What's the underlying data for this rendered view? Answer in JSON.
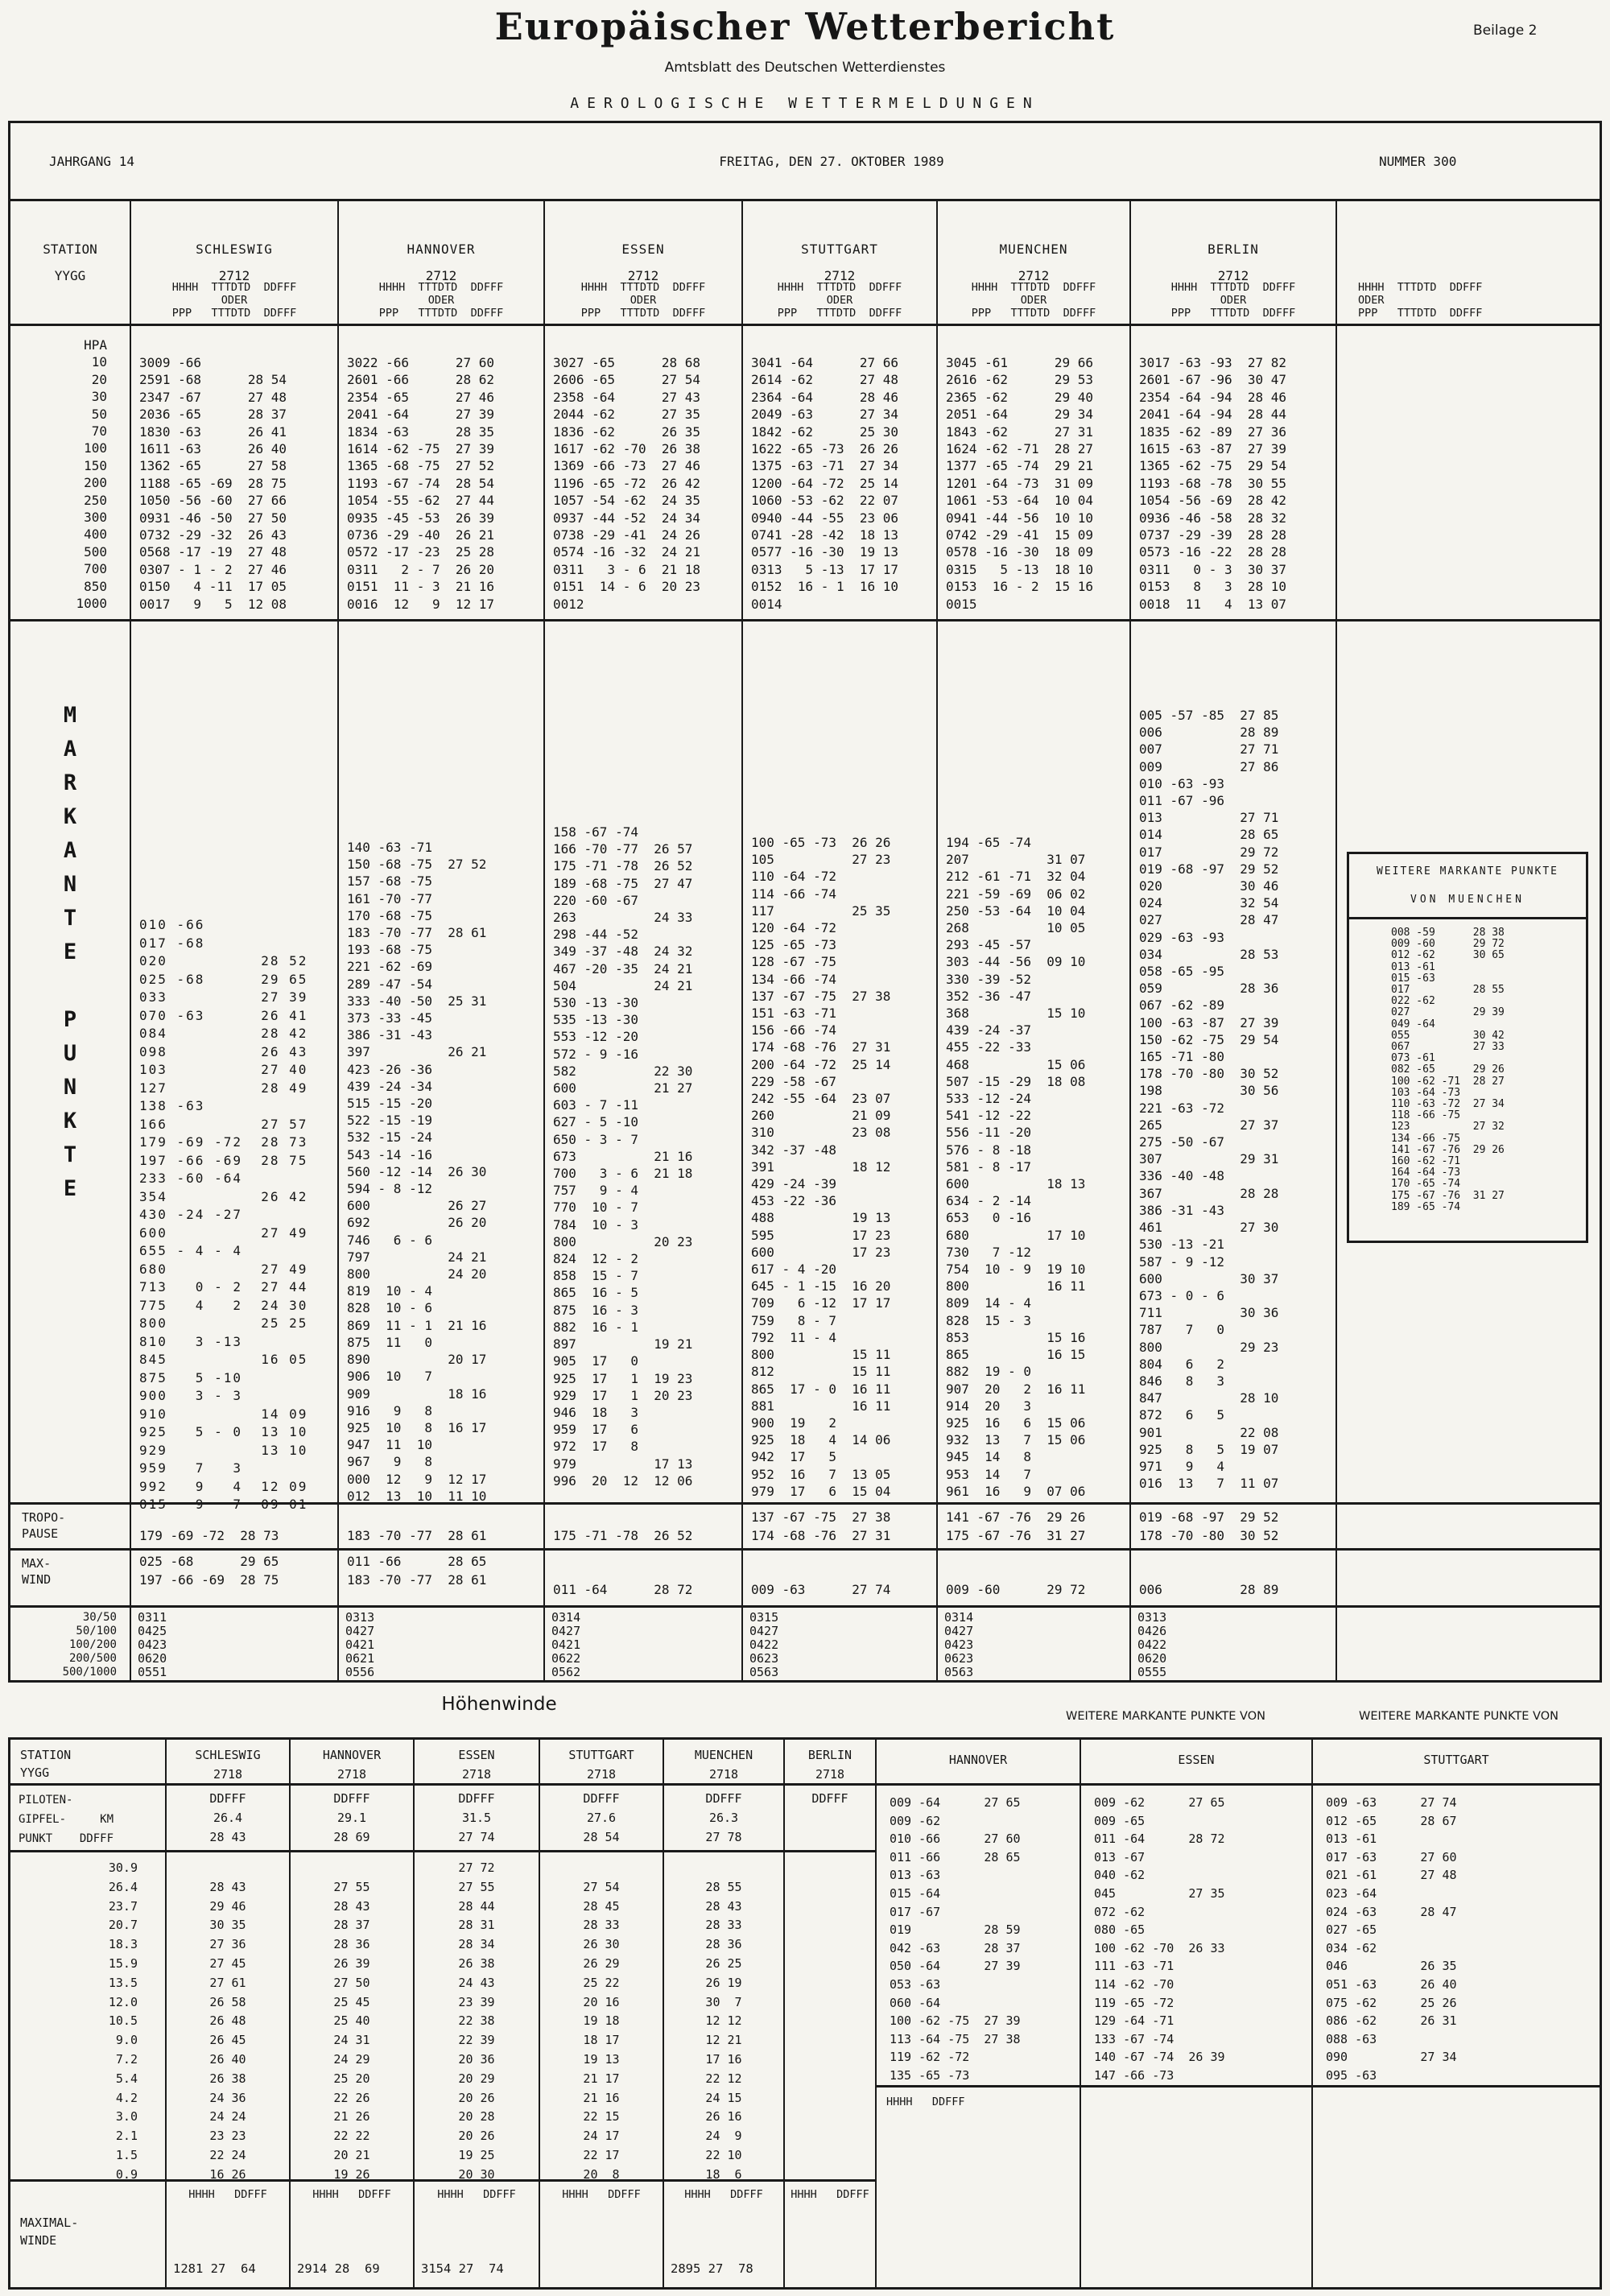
{
  "doc": {
    "title": "Europäischer Wetterbericht",
    "subtitle": "Amtsblatt des Deutschen Wetterdienstes",
    "section": "AEROLOGISCHE WETTERMELDUNGEN",
    "badge": "Beilage 2"
  },
  "infobar": {
    "left": "JAHRGANG 14",
    "center": "FREITAG, DEN 27. OKTOBER 1989",
    "right": "NUMMER 300"
  },
  "labels": {
    "station": "STATION",
    "yygg": "YYGG",
    "sub1": "HHHH  TTTDTD  DDFFF",
    "oder": "ODER",
    "sub2": "PPP   TTTDTD  DDFFF",
    "tropo": [
      "TROPO-",
      "PAUSE"
    ],
    "max": [
      "MAX-",
      "WIND"
    ],
    "ratios": [
      "30/50",
      "50/100",
      "100/200",
      "200/500",
      "500/1000"
    ],
    "markante_vertical": [
      "M",
      "A",
      "R",
      "K",
      "A",
      "N",
      "T",
      "E",
      " ",
      "P",
      "U",
      "N",
      "K",
      "T",
      "E"
    ],
    "hpa_levels": [
      "HPA",
      "10",
      "20",
      "30",
      "50",
      "70",
      "100",
      "150",
      "200",
      "250",
      "300",
      "400",
      "500",
      "700",
      "850",
      "1000"
    ]
  },
  "top_table": {
    "stations": [
      {
        "name": "SCHLESWIG",
        "yygg": "2712",
        "hpa": [
          "3009 -66",
          "2591 -68      28 54",
          "2347 -67      27 48",
          "2036 -65      28 37",
          "1830 -63      26 41",
          "1611 -63      26 40",
          "1362 -65      27 58",
          "1188 -65 -69  28 75",
          "1050 -56 -60  27 66",
          "0931 -46 -50  27 50",
          "0732 -29 -32  26 43",
          "0568 -17 -19  27 48",
          "0307 - 1 - 2  27 46",
          "0150   4 -11  17 05",
          "0017   9   5  12 08"
        ],
        "mark": [
          "010 -66",
          "017 -68",
          "020          28 52",
          "025 -68      29 65",
          "033          27 39",
          "070 -63      26 41",
          "084          28 42",
          "098          26 43",
          "103          27 40",
          "127          28 49",
          "138 -63",
          "166          27 57",
          "179 -69 -72  28 73",
          "197 -66 -69  28 75",
          "233 -60 -64",
          "354          26 42",
          "430 -24 -27",
          "600          27 49",
          "655 - 4 - 4",
          "680          27 49",
          "713   0 - 2  27 44",
          "775   4   2  24 30",
          "800          25 25",
          "810   3 -13",
          "845          16 05",
          "875   5 -10",
          "900   3 - 3",
          "910          14 09",
          "925   5 - 0  13 10",
          "929          13 10",
          "959   7   3",
          "992   9   4  12 09",
          "015   9   7  09 01"
        ],
        "tropo": [
          "179 -69 -72  28 73"
        ],
        "max": [
          "025 -68      29 65",
          "197 -66 -69  28 75"
        ],
        "ratios": [
          "0311",
          "0425",
          "0423",
          "0620",
          "0551"
        ]
      },
      {
        "name": "HANNOVER",
        "yygg": "2712",
        "hpa": [
          "3022 -66      27 60",
          "2601 -66      28 62",
          "2354 -65      27 46",
          "2041 -64      27 39",
          "1834 -63      28 35",
          "1614 -62 -75  27 39",
          "1365 -68 -75  27 52",
          "1193 -67 -74  28 54",
          "1054 -55 -62  27 44",
          "0935 -45 -53  26 39",
          "0736 -29 -40  26 21",
          "0572 -17 -23  25 28",
          "0311   2 - 7  26 20",
          "0151  11 - 3  21 16",
          "0016  12   9  12 17"
        ],
        "mark": [
          "140 -63 -71",
          "150 -68 -75  27 52",
          "157 -68 -75",
          "161 -70 -77",
          "170 -68 -75",
          "183 -70 -77  28 61",
          "193 -68 -75",
          "221 -62 -69",
          "289 -47 -54",
          "333 -40 -50  25 31",
          "373 -33 -45",
          "386 -31 -43",
          "397          26 21",
          "423 -26 -36",
          "439 -24 -34",
          "515 -15 -20",
          "522 -15 -19",
          "532 -15 -24",
          "543 -14 -16",
          "560 -12 -14  26 30",
          "594 - 8 -12",
          "600          26 27",
          "692          26 20",
          "746   6 - 6",
          "797          24 21",
          "800          24 20",
          "819  10 - 4",
          "828  10 - 6",
          "869  11 - 1  21 16",
          "875  11   0",
          "890          20 17",
          "906  10   7",
          "909          18 16",
          "916   9   8",
          "925  10   8  16 17",
          "947  11  10",
          "967   9   8",
          "000  12   9  12 17",
          "012  13  10  11 10"
        ],
        "tropo": [
          "183 -70 -77  28 61"
        ],
        "max": [
          "011 -66      28 65",
          "183 -70 -77  28 61"
        ],
        "ratios": [
          "0313",
          "0427",
          "0421",
          "0621",
          "0556"
        ]
      },
      {
        "name": "ESSEN",
        "yygg": "2712",
        "hpa": [
          "3027 -65      28 68",
          "2606 -65      27 54",
          "2358 -64      27 43",
          "2044 -62      27 35",
          "1836 -62      26 35",
          "1617 -62 -70  26 38",
          "1369 -66 -73  27 46",
          "1196 -65 -72  26 42",
          "1057 -54 -62  24 35",
          "0937 -44 -52  24 34",
          "0738 -29 -41  24 26",
          "0574 -16 -32  24 21",
          "0311   3 - 6  21 18",
          "0151  14 - 6  20 23",
          "0012"
        ],
        "mark": [
          "158 -67 -74",
          "166 -70 -77  26 57",
          "175 -71 -78  26 52",
          "189 -68 -75  27 47",
          "220 -60 -67",
          "263          24 33",
          "298 -44 -52",
          "349 -37 -48  24 32",
          "467 -20 -35  24 21",
          "504          24 21",
          "530 -13 -30",
          "535 -13 -30",
          "553 -12 -20",
          "572 - 9 -16",
          "582          22 30",
          "600          21 27",
          "603 - 7 -11",
          "627 - 5 -10",
          "650 - 3 - 7",
          "673          21 16",
          "700   3 - 6  21 18",
          "757   9 - 4",
          "770  10 - 7",
          "784  10 - 3",
          "800          20 23",
          "824  12 - 2",
          "858  15 - 7",
          "865  16 - 5",
          "875  16 - 3",
          "882  16 - 1",
          "897          19 21",
          "905  17   0",
          "925  17   1  19 23",
          "929  17   1  20 23",
          "946  18   3",
          "959  17   6",
          "972  17   8",
          "979          17 13",
          "996  20  12  12 06"
        ],
        "tropo": [
          "175 -71 -78  26 52"
        ],
        "max": [
          "011 -64      28 72"
        ],
        "ratios": [
          "0314",
          "0427",
          "0421",
          "0622",
          "0562"
        ]
      },
      {
        "name": "STUTTGART",
        "yygg": "2712",
        "hpa": [
          "3041 -64      27 66",
          "2614 -62      27 48",
          "2364 -64      28 46",
          "2049 -63      27 34",
          "1842 -62      25 30",
          "1622 -65 -73  26 26",
          "1375 -63 -71  27 34",
          "1200 -64 -72  25 14",
          "1060 -53 -62  22 07",
          "0940 -44 -55  23 06",
          "0741 -28 -42  18 13",
          "0577 -16 -30  19 13",
          "0313   5 -13  17 17",
          "0152  16 - 1  16 10",
          "0014"
        ],
        "mark": [
          "100 -65 -73  26 26",
          "105          27 23",
          "110 -64 -72",
          "114 -66 -74",
          "117          25 35",
          "120 -64 -72",
          "125 -65 -73",
          "128 -67 -75",
          "134 -66 -74",
          "137 -67 -75  27 38",
          "151 -63 -71",
          "156 -66 -74",
          "174 -68 -76  27 31",
          "200 -64 -72  25 14",
          "229 -58 -67",
          "242 -55 -64  23 07",
          "260          21 09",
          "310          23 08",
          "342 -37 -48",
          "391          18 12",
          "429 -24 -39",
          "453 -22 -36",
          "488          19 13",
          "595          17 23",
          "600          17 23",
          "617 - 4 -20",
          "645 - 1 -15  16 20",
          "709   6 -12  17 17",
          "759   8 - 7",
          "792  11 - 4",
          "800          15 11",
          "812          15 11",
          "865  17 - 0  16 11",
          "881          16 11",
          "900  19   2",
          "925  18   4  14 06",
          "942  17   5",
          "952  16   7  13 05",
          "979  17   6  15 04"
        ],
        "tropo": [
          "137 -67 -75  27 38",
          "174 -68 -76  27 31"
        ],
        "max": [
          "009 -63      27 74"
        ],
        "ratios": [
          "0315",
          "0427",
          "0422",
          "0623",
          "0563"
        ]
      },
      {
        "name": "MUENCHEN",
        "yygg": "2712",
        "hpa": [
          "3045 -61      29 66",
          "2616 -62      29 53",
          "2365 -62      29 40",
          "2051 -64      29 34",
          "1843 -62      27 31",
          "1624 -62 -71  28 27",
          "1377 -65 -74  29 21",
          "1201 -64 -73  31 09",
          "1061 -53 -64  10 04",
          "0941 -44 -56  10 10",
          "0742 -29 -41  15 09",
          "0578 -16 -30  18 09",
          "0315   5 -13  18 10",
          "0153  16 - 2  15 16",
          "0015"
        ],
        "mark": [
          "194 -65 -74",
          "207          31 07",
          "212 -61 -71  32 04",
          "221 -59 -69  06 02",
          "250 -53 -64  10 04",
          "268          10 05",
          "293 -45 -57",
          "303 -44 -56  09 10",
          "330 -39 -52",
          "352 -36 -47",
          "368          15 10",
          "439 -24 -37",
          "455 -22 -33",
          "468          15 06",
          "507 -15 -29  18 08",
          "533 -12 -24",
          "541 -12 -22",
          "556 -11 -20",
          "576 - 8 -18",
          "581 - 8 -17",
          "600          18 13",
          "634 - 2 -14",
          "653   0 -16",
          "680          17 10",
          "730   7 -12",
          "754  10 - 9  19 10",
          "800          16 11",
          "809  14 - 4",
          "828  15 - 3",
          "853          15 16",
          "865          16 15",
          "882  19 - 0",
          "907  20   2  16 11",
          "914  20   3",
          "925  16   6  15 06",
          "932  13   7  15 06",
          "945  14   8",
          "953  14   7",
          "961  16   9  07 06"
        ],
        "tropo": [
          "141 -67 -76  29 26",
          "175 -67 -76  31 27"
        ],
        "max": [
          "009 -60      29 72"
        ],
        "ratios": [
          "0314",
          "0427",
          "0423",
          "0623",
          "0563"
        ]
      },
      {
        "name": "BERLIN",
        "yygg": "2712",
        "hpa": [
          "3017 -63 -93  27 82",
          "2601 -67 -96  30 47",
          "2354 -64 -94  28 46",
          "2041 -64 -94  28 44",
          "1835 -62 -89  27 36",
          "1615 -63 -87  27 39",
          "1365 -62 -75  29 54",
          "1193 -68 -78  30 55",
          "1054 -56 -69  28 42",
          "0936 -46 -58  28 32",
          "0737 -29 -39  28 28",
          "0573 -16 -22  28 28",
          "0311   0 - 3  30 37",
          "0153   8   3  28 10",
          "0018  11   4  13 07"
        ],
        "mark": [
          "005 -57 -85  27 85",
          "006          28 89",
          "007          27 71",
          "009          27 86",
          "010 -63 -93",
          "011 -67 -96",
          "013          27 71",
          "014          28 65",
          "017          29 72",
          "019 -68 -97  29 52",
          "020          30 46",
          "024          32 54",
          "027          28 47",
          "029 -63 -93",
          "034          28 53",
          "058 -65 -95",
          "059          28 36",
          "067 -62 -89",
          "100 -63 -87  27 39",
          "150 -62 -75  29 54",
          "165 -71 -80",
          "178 -70 -80  30 52",
          "198          30 56",
          "221 -63 -72",
          "265          27 37",
          "275 -50 -67",
          "307          29 31",
          "336 -40 -48",
          "367          28 28",
          "386 -31 -43",
          "461          27 30",
          "530 -13 -21",
          "587 - 9 -12",
          "600          30 37",
          "673 - 0 - 6",
          "711          30 36",
          "787   7   0",
          "800          29 23",
          "804   6   2",
          "846   8   3",
          "847          28 10",
          "872   6   5",
          "901          22 08",
          "925   8   5  19 07",
          "971   9   4",
          "016  13   7  11 07"
        ],
        "tropo": [
          "019 -68 -97  29 52",
          "178 -70 -80  30 52"
        ],
        "max": [
          "006          28 89"
        ],
        "ratios": [
          "0313",
          "0426",
          "0422",
          "0620",
          "0555"
        ]
      }
    ]
  },
  "wmp_box": {
    "line1": "WEITERE MARKANTE PUNKTE",
    "line2": "VON  MUENCHEN",
    "lines": [
      "008 -59      28 38",
      "009 -60      29 72",
      "012 -62      30 65",
      "013 -61",
      "015 -63",
      "017          28 55",
      "022 -62",
      "027          29 39",
      "049 -64",
      "055          30 42",
      "067          27 33",
      "073 -61",
      "082 -65      29 26",
      "100 -62 -71  28 27",
      "103 -64 -73",
      "110 -63 -72  27 34",
      "118 -66 -75",
      "123          27 32",
      "134 -66 -75",
      "141 -67 -76  29 26",
      "160 -62 -71",
      "164 -64 -73",
      "170 -65 -74",
      "175 -67 -76  31 27",
      "189 -65 -74"
    ]
  },
  "hoehen": {
    "title": "Höhenwinde",
    "wmp_label_1": "WEITERE MARKANTE PUNKTE VON",
    "wmp_label_2": "WEITERE MARKANTE PUNKTE VON",
    "station": "STATION",
    "yygg": "YYGG",
    "piloten": [
      "PILOTEN-",
      "GIPFEL-     KM",
      "PUNKT    DDFFF"
    ],
    "maximal": [
      "MAXIMAL-",
      "WINDE"
    ],
    "hhhh_ddfff": "HHHH   DDFFF",
    "km": [
      " 30.9",
      " 26.4",
      " 23.7",
      " 20.7",
      " 18.3",
      " 15.9",
      " 13.5",
      " 12.0",
      " 10.5",
      "  9.0",
      "  7.2",
      "  5.4",
      "  4.2",
      "  3.0",
      "  2.1",
      "  1.5",
      "  0.9"
    ],
    "stations": [
      {
        "name": "SCHLESWIG",
        "yygg": "2718",
        "head": [
          "DDFFF",
          "26.4",
          "28 43"
        ],
        "winds": [
          "",
          "28 43",
          "29 46",
          "30 35",
          "27 36",
          "27 45",
          "27 61",
          "26 58",
          "26 48",
          "26 45",
          "26 40",
          "26 38",
          "24 36",
          "24 24",
          "23 23",
          "22 24",
          "16 26"
        ],
        "maxv": "1281 27  64"
      },
      {
        "name": "HANNOVER",
        "yygg": "2718",
        "head": [
          "DDFFF",
          "29.1",
          "28 69"
        ],
        "winds": [
          "",
          "27 55",
          "28 43",
          "28 37",
          "28 36",
          "26 39",
          "27 50",
          "25 45",
          "25 40",
          "24 31",
          "24 29",
          "25 20",
          "22 26",
          "21 26",
          "22 22",
          "20 21",
          "19 26"
        ],
        "maxv": "2914 28  69"
      },
      {
        "name": "ESSEN",
        "yygg": "2718",
        "head": [
          "DDFFF",
          "31.5",
          "27 74"
        ],
        "winds": [
          "27 72",
          "27 55",
          "28 44",
          "28 31",
          "28 34",
          "26 38",
          "24 43",
          "23 39",
          "22 38",
          "22 39",
          "20 36",
          "20 29",
          "20 26",
          "20 28",
          "20 26",
          "19 25",
          "20 30"
        ],
        "maxv": "3154 27  74"
      },
      {
        "name": "STUTTGART",
        "yygg": "2718",
        "head": [
          "DDFFF",
          "27.6",
          "28 54"
        ],
        "winds": [
          "",
          "27 54",
          "28 45",
          "28 33",
          "26 30",
          "26 29",
          "25 22",
          "20 16",
          "19 18",
          "18 17",
          "19 13",
          "21 17",
          "21 16",
          "22 15",
          "24 17",
          "22 17",
          "20  8"
        ],
        "maxv": ""
      },
      {
        "name": "MUENCHEN",
        "yygg": "2718",
        "head": [
          "DDFFF",
          "26.3",
          "27 78"
        ],
        "winds": [
          "",
          "28 55",
          "28 43",
          "28 33",
          "28 36",
          "26 25",
          "26 19",
          "30  7",
          "12 12",
          "12 21",
          "17 16",
          "22 12",
          "24 15",
          "26 16",
          "24  9",
          "22 10",
          "18  6"
        ],
        "maxv": "2895 27  78"
      },
      {
        "name": "BERLIN",
        "yygg": "2718",
        "head": [
          "DDFFF"
        ],
        "winds": [
          "",
          "",
          "",
          "",
          "",
          "",
          "",
          "",
          "",
          "",
          "",
          "",
          "",
          "",
          "",
          "",
          ""
        ],
        "maxv": ""
      }
    ],
    "wmp_cols": [
      {
        "name": "HANNOVER",
        "lines": [
          "009 -64      27 65",
          "009 -62",
          "010 -66      27 60",
          "011 -66      28 65",
          "013 -63",
          "015 -64",
          "017 -67",
          "019          28 59",
          "042 -63      28 37",
          "050 -64      27 39",
          "053 -63",
          "060 -64",
          "100 -62 -75  27 39",
          "113 -64 -75  27 38",
          "119 -62 -72",
          "135 -65 -73"
        ]
      },
      {
        "name": "ESSEN",
        "lines": [
          "009 -62      27 65",
          "009 -65",
          "011 -64      28 72",
          "013 -67",
          "040 -62",
          "045          27 35",
          "072 -62",
          "080 -65",
          "100 -62 -70  26 33",
          "111 -63 -71",
          "114 -62 -70",
          "119 -65 -72",
          "129 -64 -71",
          "133 -67 -74",
          "140 -67 -74  26 39",
          "147 -66 -73"
        ]
      },
      {
        "name": "STUTTGART",
        "lines": [
          "009 -63      27 74",
          "012 -65      28 67",
          "013 -61",
          "017 -63      27 60",
          "021 -61      27 48",
          "023 -64",
          "024 -63      28 47",
          "027 -65",
          "034 -62",
          "046          26 35",
          "051 -63      26 40",
          "075 -62      25 26",
          "086 -62      26 31",
          "088 -63",
          "090          27 34",
          "095 -63"
        ]
      }
    ]
  }
}
